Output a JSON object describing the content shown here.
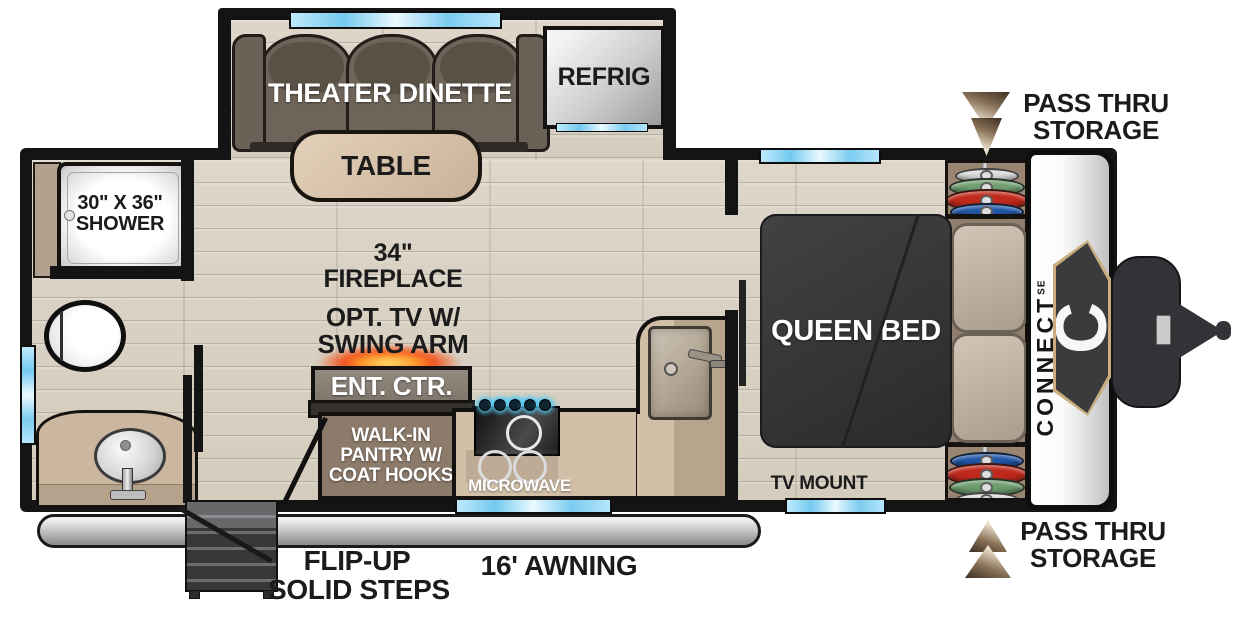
{
  "title": "Travel trailer floor plan - Connect SE",
  "labels": {
    "theater_dinette": "THEATER DINETTE",
    "table": "TABLE",
    "refrig": "REFRIG",
    "shower_line1": "30\" X 36\"",
    "shower_line2": "SHOWER",
    "fireplace_line1": "34\"",
    "fireplace_line2": "FIREPLACE",
    "opt_tv_line1": "OPT. TV W/",
    "opt_tv_line2": "SWING ARM",
    "ent_ctr": "ENT. CTR.",
    "pantry_line1": "WALK-IN",
    "pantry_line2": "PANTRY W/",
    "pantry_line3": "COAT HOOKS",
    "microwave": "MICROWAVE",
    "queen_bed": "QUEEN BED",
    "tv_mount": "TV MOUNT",
    "pass_thru_line1": "PASS THRU",
    "pass_thru_line2": "STORAGE",
    "steps_line1": "FLIP-UP",
    "steps_line2": "SOLID STEPS",
    "awning": "16' AWNING",
    "brand": "CONNECT",
    "brand_sub": "SE",
    "brand_badge": "C"
  },
  "wardrobes": {
    "top": [
      "#d9d9d9",
      "#6f9e6f",
      "#c0291c",
      "#1f56a8"
    ],
    "bottom": [
      "#1f56a8",
      "#c0291c",
      "#6f9e6f",
      "#d9d9d9"
    ]
  },
  "colors": {
    "wall_black": "#141414",
    "floor_wood": "#d8d0c2",
    "window_blue": "#8fd4f2",
    "couch_brown": "#6e6459",
    "counter_beige": "#d2bfa7",
    "bed_dark": "#353537",
    "pillow_beige": "#c6b9ab",
    "cabinet_brown": "#8c7a6a",
    "badge_gold": "#c9ad7c",
    "fire_glow": "#ff9b2e",
    "burner_glow": "#58c8f0",
    "awning_silver": "#c2c2c2",
    "arrow_tan": "#efe5d1"
  }
}
